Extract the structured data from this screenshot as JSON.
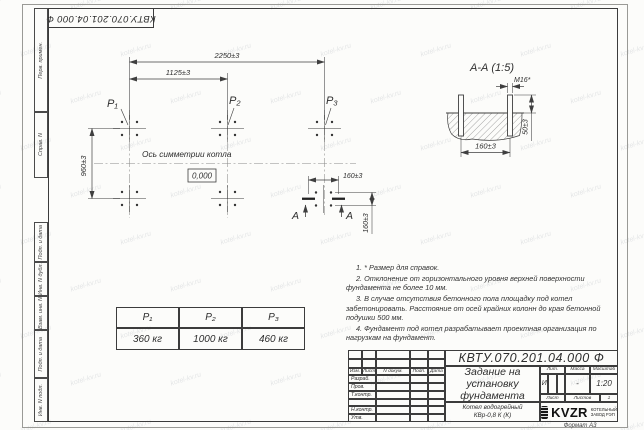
{
  "watermark": {
    "text": "kotel-kv.ru"
  },
  "top_stamp": {
    "doc_number": "КВТУ.070.201.04.000 Ф"
  },
  "sidebar": {
    "top_cells": [
      {
        "label": "Перв. примен."
      },
      {
        "label": "Справ. N"
      }
    ],
    "bottom_cells": [
      {
        "label": "Подп. и дата"
      },
      {
        "label": "Инв. N дубл."
      },
      {
        "label": "Взам. инв. N"
      },
      {
        "label": "Подп. и дата"
      },
      {
        "label": "Инв. N подл."
      }
    ]
  },
  "plan": {
    "dim_overall": "2250±3",
    "dim_half": "1125±3",
    "dim_depth": "960±3",
    "dim_bolt_x": "160±3",
    "dim_bolt_y": "160±3",
    "load_labels": [
      "P₁",
      "P₂",
      "P₃"
    ],
    "axis_label": "Ось симметрии котла",
    "level_mark": "0,000",
    "section_letter_left": "А",
    "section_letter_right": "А"
  },
  "section": {
    "title": "А-А (1:5)",
    "thread_label": "M16*",
    "dim_protrusion": "50±3",
    "dim_spacing": "160±3"
  },
  "loads_table": {
    "headers": [
      "P₁",
      "P₂",
      "P₃"
    ],
    "values": [
      "360 кг",
      "1000 кг",
      "460 кг"
    ]
  },
  "notes": [
    "1. * Размер для справок.",
    "2. Отклонение от горизонтального уровня верхней поверхности фундамента не более 10 мм.",
    "3. В случае отсутствия бетонного пола площадку под котел забетонировать. Расстояние от осей крайних колонн до края бетонной подушки 500 мм.",
    "4. Фундамент под котел разрабатывает проектная организация по нагрузкам на фундамент."
  ],
  "title_block": {
    "doc_number": "КВТУ.070.201.04.000 Ф",
    "title": "Задание на установку фундамента",
    "product": "Котел водогрейный КВр-0,8 К (К)",
    "cols": [
      "Изм.",
      "Лист",
      "N докум.",
      "Подп.",
      "Дата"
    ],
    "rows": [
      "Разраб.",
      "Пров.",
      "Т.контр.",
      "",
      "Н.контр.",
      "Утв."
    ],
    "lit_label": "Лит.",
    "mass_label": "Масса",
    "scale_label": "Масштаб",
    "lit_value": "И",
    "mass_value": "-",
    "scale_value": "1:20",
    "sheet_label": "Лист",
    "sheets_label": "Листов",
    "sheets_value": "1",
    "logo_text": "KVZR",
    "logo_sub1": "КОТЕЛЬНЫЙ",
    "logo_sub2": "ЗАВОД РЭП",
    "format_label": "Формат А3"
  }
}
